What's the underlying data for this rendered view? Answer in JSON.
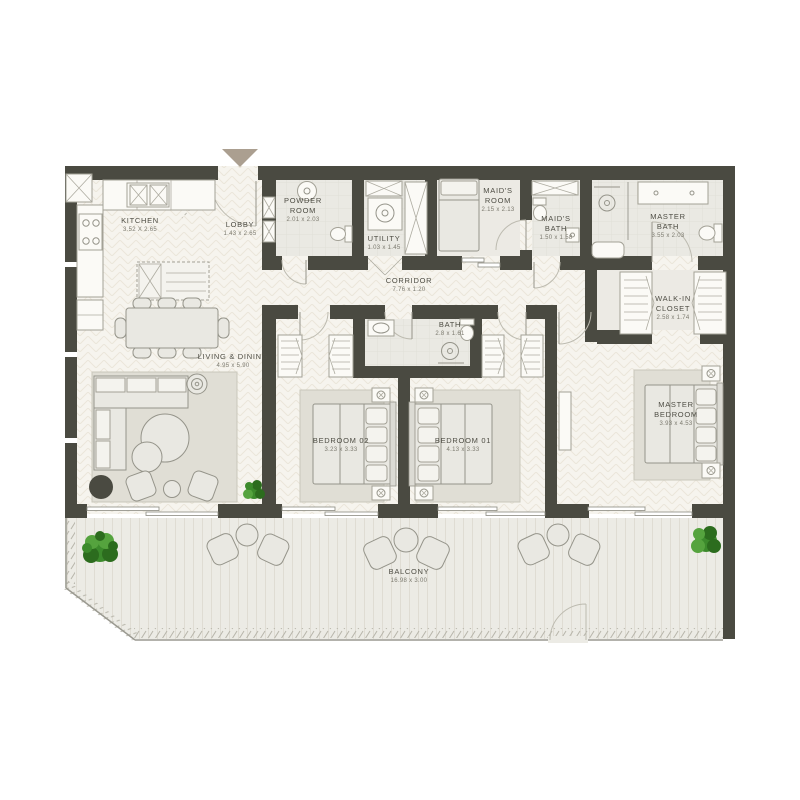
{
  "plan": {
    "type": "apartment-floor-plan",
    "rooms": [
      {
        "id": "kitchen",
        "label": "KITCHEN",
        "dims": "3.52 X 2.65"
      },
      {
        "id": "lobby",
        "label": "LOBBY",
        "dims": "1.43 x 2.65"
      },
      {
        "id": "powder-room",
        "label": "POWDER\nROOM",
        "dims": "2.01 x 2.03"
      },
      {
        "id": "utility",
        "label": "UTILITY",
        "dims": "1.03 x 1.45"
      },
      {
        "id": "maids-room",
        "label": "MAID'S\nROOM",
        "dims": "2.15 x 2.13"
      },
      {
        "id": "maids-bath",
        "label": "MAID'S\nBATH",
        "dims": "1.50 x 1.58"
      },
      {
        "id": "master-bath",
        "label": "MASTER\nBATH",
        "dims": "3.55 x 2.03"
      },
      {
        "id": "corridor",
        "label": "CORRIDOR",
        "dims": "7.76 x 1.20"
      },
      {
        "id": "bath",
        "label": "BATH",
        "dims": "2.8 x 1.61"
      },
      {
        "id": "walk-in-closet",
        "label": "WALK-IN\nCLOSET",
        "dims": "2.58 x 1.74"
      },
      {
        "id": "living-dining",
        "label": "LIVING & DINING",
        "dims": "4.95 x 5.90"
      },
      {
        "id": "bedroom-02",
        "label": "BEDROOM 02",
        "dims": "3.23 x 3.33"
      },
      {
        "id": "bedroom-01",
        "label": "BEDROOM 01",
        "dims": "4.13 x 3.33"
      },
      {
        "id": "master-bedroom",
        "label": "MASTER\nBEDROOM",
        "dims": "3.93 x 4.53"
      },
      {
        "id": "balcony",
        "label": "BALCONY",
        "dims": "16.98 x 3.00"
      }
    ],
    "icons": {
      "entry_arrow": "triangle-down",
      "bed_lamp": "circled-x",
      "plant": "foliage-cluster"
    },
    "colors": {
      "wall": "#4a4a41",
      "floor": "#f6f4ee",
      "wet_floor": "#eae9e3",
      "balcony_floor": "#ecebe5",
      "rug": "#e0ded5",
      "furniture_stroke": "#95948a",
      "plant_green_dark": "#2c6c1e",
      "plant_green": "#3c8a2c",
      "plant_green_light": "#55a33e",
      "entry_arrow": "#ab9f90",
      "label_text": "#4e4d44",
      "dims_text": "#7b796e"
    }
  }
}
